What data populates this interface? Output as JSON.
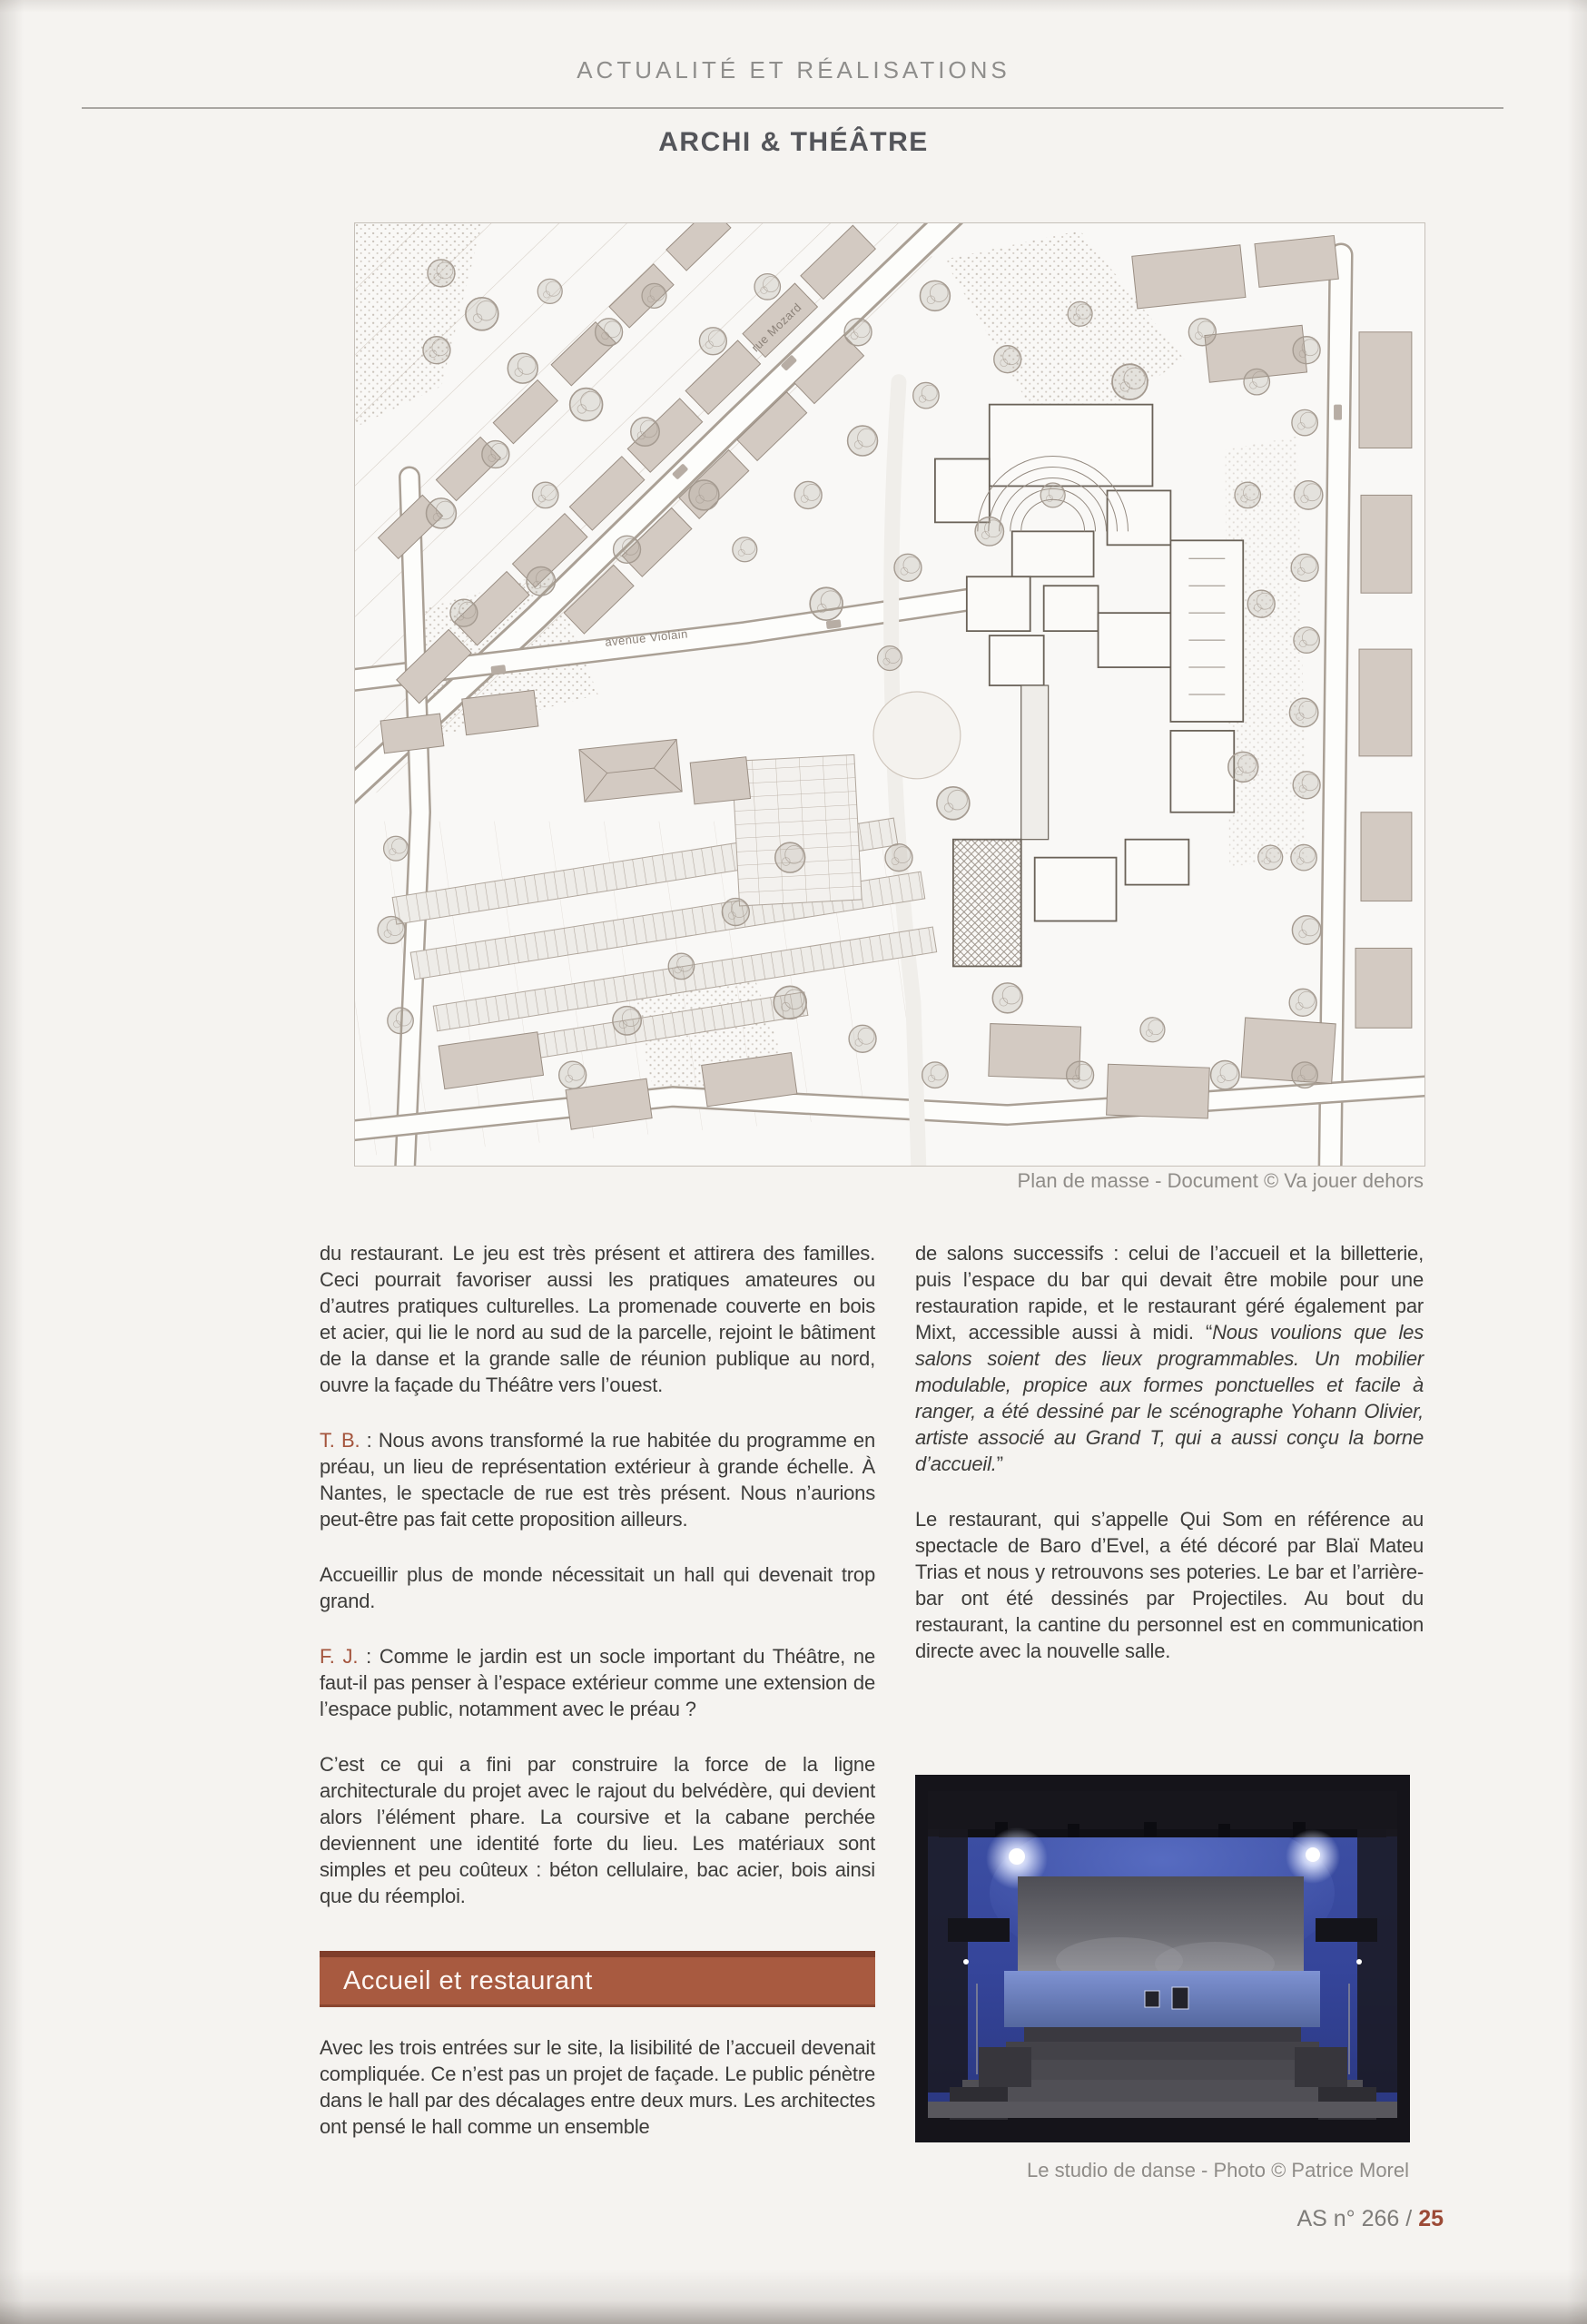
{
  "header": {
    "kicker": "ACTUALITÉ ET RÉALISATIONS",
    "title": "ARCHI & THÉÂTRE"
  },
  "plan": {
    "caption": "Plan de masse - Document © Va jouer dehors",
    "labels": [
      {
        "text": "rue Mozard"
      },
      {
        "text": "avenue Violain"
      }
    ]
  },
  "columns": {
    "left": {
      "p1": "du restaurant. Le jeu est très présent et attirera des familles. Ceci pourrait favoriser aussi les pratiques amateures ou d’autres pratiques culturelles. La promenade couverte en bois et acier, qui lie le nord au sud de la parcelle, rejoint le bâtiment de la danse et la grande salle de réunion publique au nord, ouvre la façade du Théâtre vers l’ouest.",
      "p2_speaker": "T. B.",
      "p2_text": " : Nous avons transformé la rue habitée du programme en préau, un lieu de représentation extérieur à grande échelle. À Nantes, le spectacle de rue est très présent. Nous n’aurions peut-être pas fait cette proposition ailleurs.",
      "p3": "Accueillir plus de monde nécessitait un hall qui devenait trop grand.",
      "p4_speaker": "F. J.",
      "p4_text": " : Comme le jardin est un socle important du Théâtre, ne faut-il pas penser à l’espace extérieur comme une extension de l’espace public, notamment avec le préau ?",
      "p5": "C’est ce qui a fini par construire la force de la ligne architecturale du projet avec le rajout du belvédère, qui devient alors l’élément phare. La coursive et la cabane perchée deviennent une identité forte du lieu. Les matériaux sont simples et peu coûteux : béton cellulaire, bac acier, bois ainsi que du réemploi.",
      "section_heading": "Accueil et restaurant",
      "p6": "Avec les trois entrées sur le site, la lisibilité de l’accueil devenait compliquée. Ce n’est pas un projet de façade. Le public pénètre dans le hall par des décalages entre deux murs. Les architectes ont pensé le hall comme un ensemble"
    },
    "right": {
      "p1_intro": "de salons successifs : celui de l’accueil et la billetterie, puis l’espace du bar qui devait être mobile pour une restauration rapide, et le restaurant géré également par Mixt, accessible aussi à midi. “",
      "p1_quote": "Nous voulions que les salons soient des lieux programmables. Un mobilier modulable, propice aux formes ponctuelles et facile à ranger, a été dessiné par le scénographe Yohann Olivier, artiste associé au Grand T, qui a aussi conçu la borne d’accueil.",
      "p1_close": "”",
      "p2": "Le restaurant, qui s’appelle Qui Som en référence au spectacle de Baro d’Evel, a été décoré par Blaï Mateu Trias et nous y retrouvons ses poteries. Le bar et l’arrière-bar ont été dessinés par Projectiles. Au bout du restaurant, la cantine du personnel est en communication directe avec la nouvelle salle.",
      "photo_caption": "Le studio de danse - Photo © Patrice Morel"
    }
  },
  "footer": {
    "label": "AS n° 266 / ",
    "page_number": "25"
  },
  "colors": {
    "accent": "#a85a40",
    "accent_dark": "#7f3d2a",
    "page_number": "#9c4a36"
  }
}
